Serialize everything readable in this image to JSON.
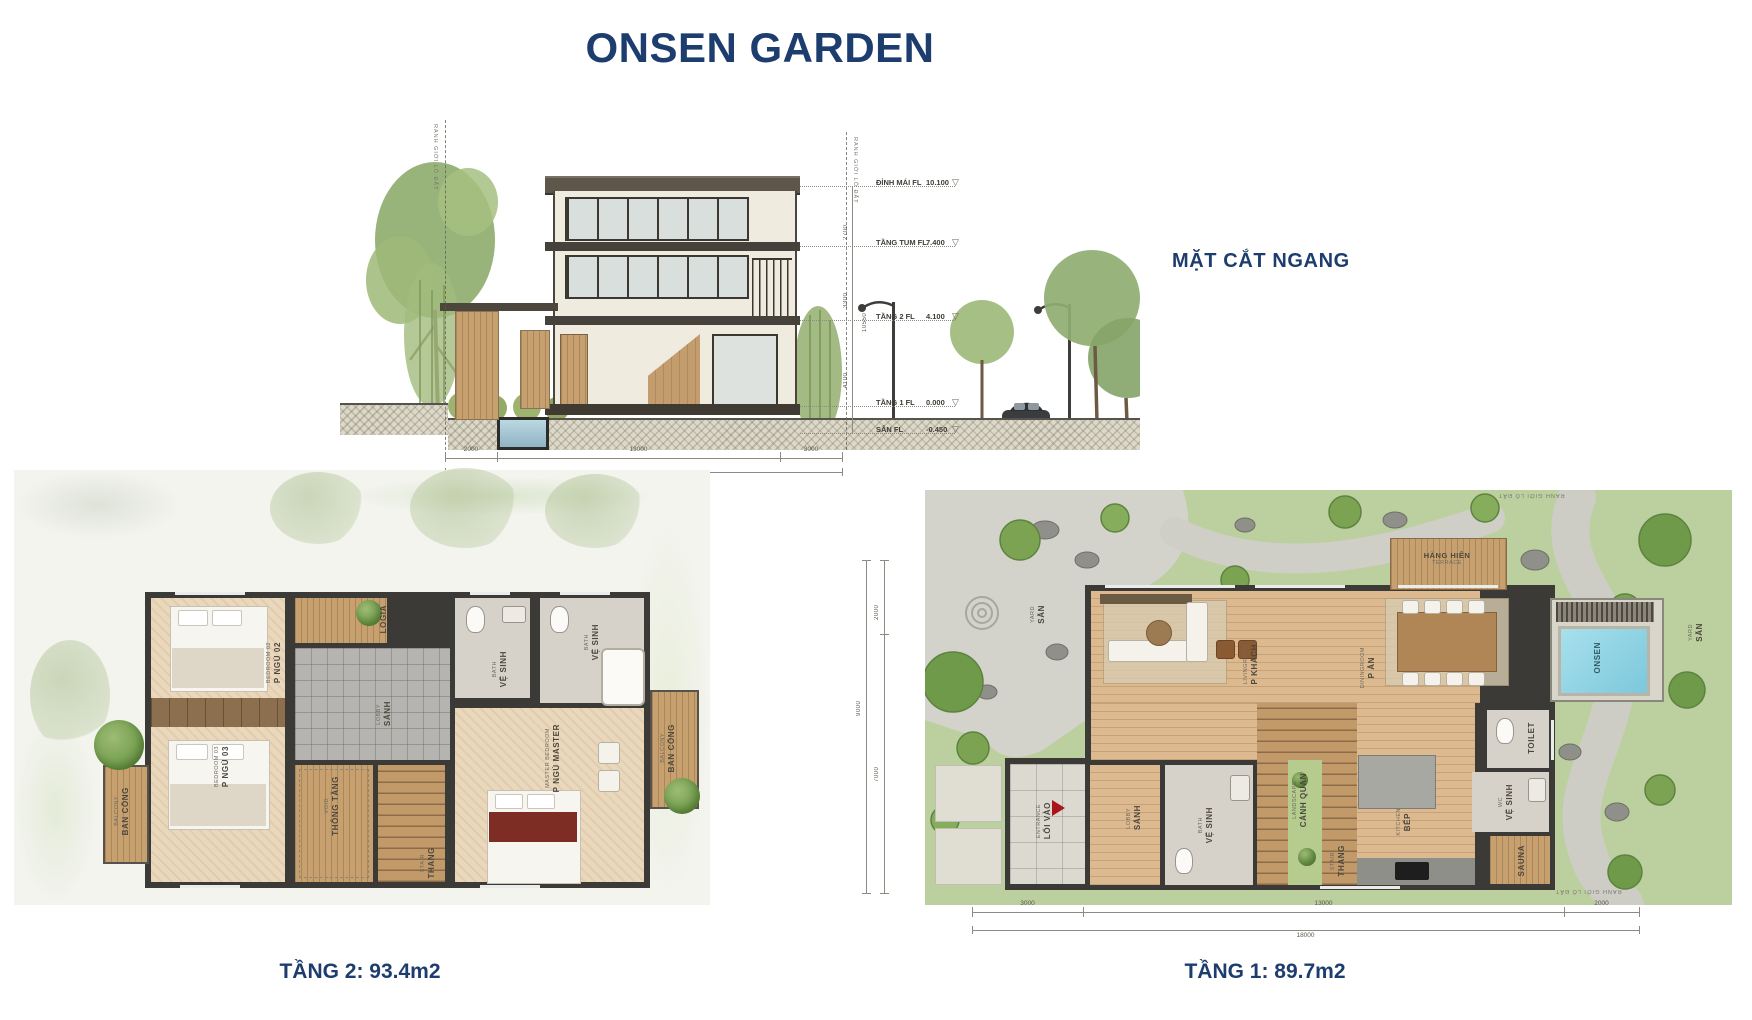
{
  "title": "ONSEN GARDEN",
  "icons": {
    "level_marker": "▽"
  },
  "section": {
    "label": "MẶT CẮT NGANG",
    "boundary_label": "RANH GIỚI LÔ ĐẤT",
    "levels": [
      {
        "name": "ĐỈNH MÁI FL",
        "value": "10.100"
      },
      {
        "name": "TẦNG TUM  FL",
        "value": "7.400"
      },
      {
        "name": "TẦNG 2  FL",
        "value": "4.100"
      },
      {
        "name": "TẦNG 1  FL",
        "value": "0.000"
      },
      {
        "name": "SÂN  FL",
        "value": "-0.450"
      }
    ],
    "height_dims": [
      "2700",
      "3300",
      "4100"
    ],
    "height_total": "10550",
    "bottom_dims": [
      "2000",
      "13000",
      "3000"
    ],
    "bottom_total": "18000"
  },
  "floor2": {
    "caption": "TẦNG 2: 93.4m2",
    "rooms": [
      {
        "vi": "P NGỦ 02",
        "en": "BEDROOM 02"
      },
      {
        "vi": "LOGIA",
        "en": ""
      },
      {
        "vi": "VỆ SINH",
        "en": "BATH"
      },
      {
        "vi": "VỆ SINH",
        "en": "BATH"
      },
      {
        "vi": "SẢNH",
        "en": "LOBBY"
      },
      {
        "vi": "P NGỦ 03",
        "en": "BEDROOM 03"
      },
      {
        "vi": "THÔNG TẦNG",
        "en": "VOID"
      },
      {
        "vi": "THANG",
        "en": "STAIR"
      },
      {
        "vi": "P NGỦ MASTER",
        "en": "MASTER BEDROOM"
      },
      {
        "vi": "BAN CÔNG",
        "en": "BALCONY"
      },
      {
        "vi": "BAN CÔNG",
        "en": "BALCONY"
      }
    ]
  },
  "floor1": {
    "caption": "TẦNG 1: 89.7m2",
    "boundary_label": "RANH GIỚI LÔ ĐẤT",
    "rooms": [
      {
        "vi": "SÂN",
        "en": "YARD"
      },
      {
        "vi": "P KHÁCH",
        "en": "LIVINGROOM"
      },
      {
        "vi": "P ĂN",
        "en": "DININGROOM"
      },
      {
        "vi": "HÀNG HIÊN",
        "en": "TERRACE"
      },
      {
        "vi": "ONSEN",
        "en": ""
      },
      {
        "vi": "SÂN",
        "en": "YARD"
      },
      {
        "vi": "TOILET",
        "en": ""
      },
      {
        "vi": "VỆ SINH",
        "en": "WC"
      },
      {
        "vi": "SAUNA",
        "en": ""
      },
      {
        "vi": "BẾP",
        "en": "KITCHEN"
      },
      {
        "vi": "THANG",
        "en": "STAIR"
      },
      {
        "vi": "CẢNH QUAN",
        "en": "LANDSCAPE"
      },
      {
        "vi": "VỆ SINH",
        "en": "BATH"
      },
      {
        "vi": "SẢNH",
        "en": "LOBBY"
      },
      {
        "vi": "LỐI VÀO",
        "en": "ENTRANCE"
      }
    ],
    "side_dims": [
      "2000",
      "7000"
    ],
    "side_total": "9000",
    "bottom_dims": [
      "3000",
      "13000",
      "2000"
    ],
    "bottom_total": "18000"
  }
}
